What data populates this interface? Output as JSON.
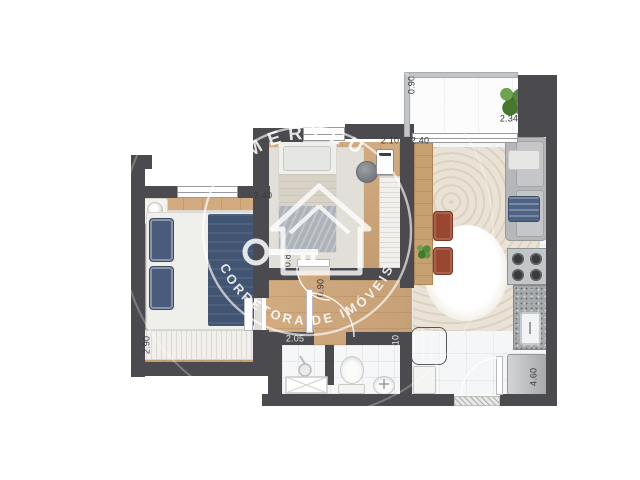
{
  "watermark": {
    "brand": "MERYLU",
    "tagline": "CORRETORA DE IMÓVEIS",
    "color": "#ffffff",
    "icons": [
      "house-outline-icon",
      "key-icon",
      "circle-badge-icon"
    ]
  },
  "palette": {
    "wall": "#4a4a4f",
    "wood_floor": "#cba47a",
    "tile_floor": "#f5f6f7",
    "navy_textile": "#4b5b7c",
    "rust_chair": "#9a4732",
    "plant_green": "#4c7c3c",
    "sofa_gray": "#b5b7b9"
  },
  "icons": {
    "plant": "potted-plant-icon",
    "shower": "shower-head-icon",
    "stove": "stove-burners-icon",
    "key": "key-icon",
    "house": "house-outline-icon"
  },
  "dimensions": [
    {
      "label": "2.40",
      "room": "bedroom-1",
      "x": 263,
      "y": 196,
      "vertical": false,
      "tone": "dark"
    },
    {
      "label": "2.90",
      "room": "bedroom-1",
      "x": 147,
      "y": 345,
      "vertical": true,
      "tone": "dark"
    },
    {
      "label": "2.10",
      "room": "bedroom-2",
      "x": 390,
      "y": 141,
      "vertical": false,
      "tone": "dark"
    },
    {
      "label": "2.40",
      "room": "living-room",
      "x": 420,
      "y": 141,
      "vertical": false,
      "tone": "dark"
    },
    {
      "label": "0.90",
      "room": "balcony",
      "x": 412,
      "y": 85,
      "vertical": true,
      "tone": "dark"
    },
    {
      "label": "2.34",
      "room": "balcony",
      "x": 509,
      "y": 119,
      "vertical": false,
      "tone": "dark"
    },
    {
      "label": "0.80",
      "room": "hallway",
      "x": 288,
      "y": 258,
      "vertical": true,
      "tone": "dark"
    },
    {
      "label": "0.90",
      "room": "hallway",
      "x": 321,
      "y": 288,
      "vertical": true,
      "tone": "dark"
    },
    {
      "label": "2.05",
      "room": "bathroom",
      "x": 295,
      "y": 339,
      "vertical": false,
      "tone": "light"
    },
    {
      "label": "1.10",
      "room": "bathroom",
      "x": 396,
      "y": 344,
      "vertical": true,
      "tone": "light"
    },
    {
      "label": "4.60",
      "room": "kitchen",
      "x": 534,
      "y": 377,
      "vertical": true,
      "tone": "dark"
    }
  ]
}
